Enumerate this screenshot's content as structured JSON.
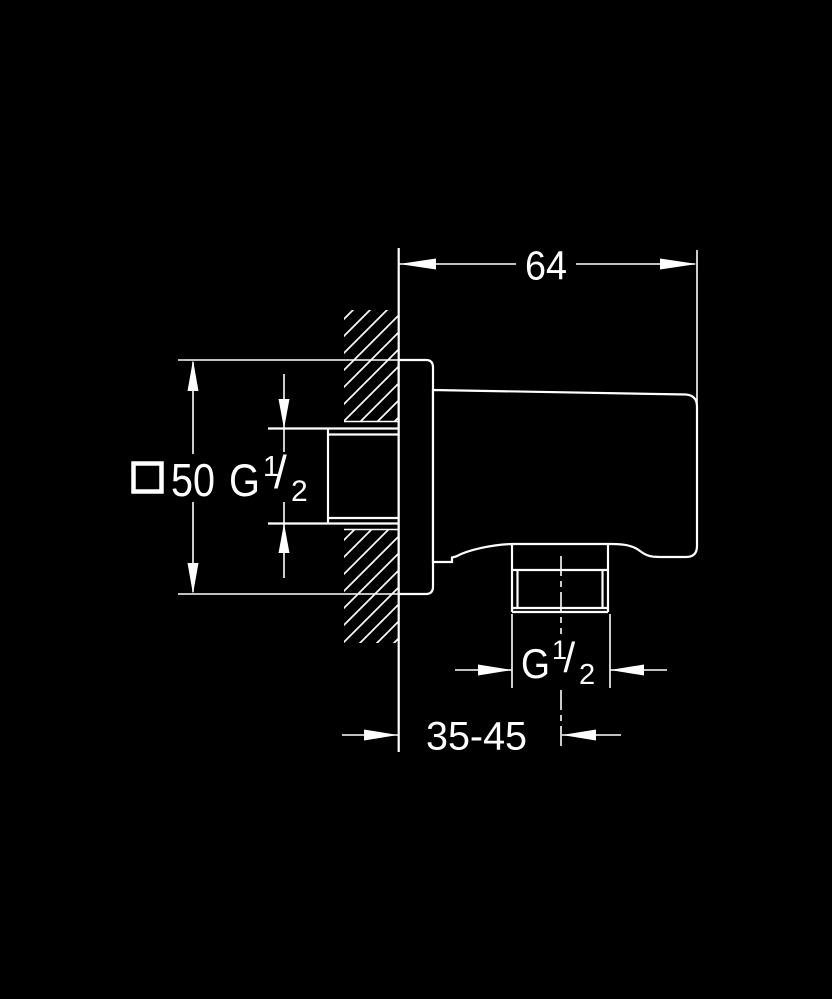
{
  "drawing": {
    "colors": {
      "background": "#000000",
      "line": "#ffffff"
    },
    "labels": {
      "width": "64",
      "face_symbol": "square",
      "face": "50",
      "inlet_thread": {
        "g": "G",
        "num": "1",
        "slash": "/",
        "den": "2"
      },
      "outlet_thread": {
        "g": "G",
        "num": "1",
        "slash": "/",
        "den": "2"
      },
      "depth": "35-45"
    }
  }
}
